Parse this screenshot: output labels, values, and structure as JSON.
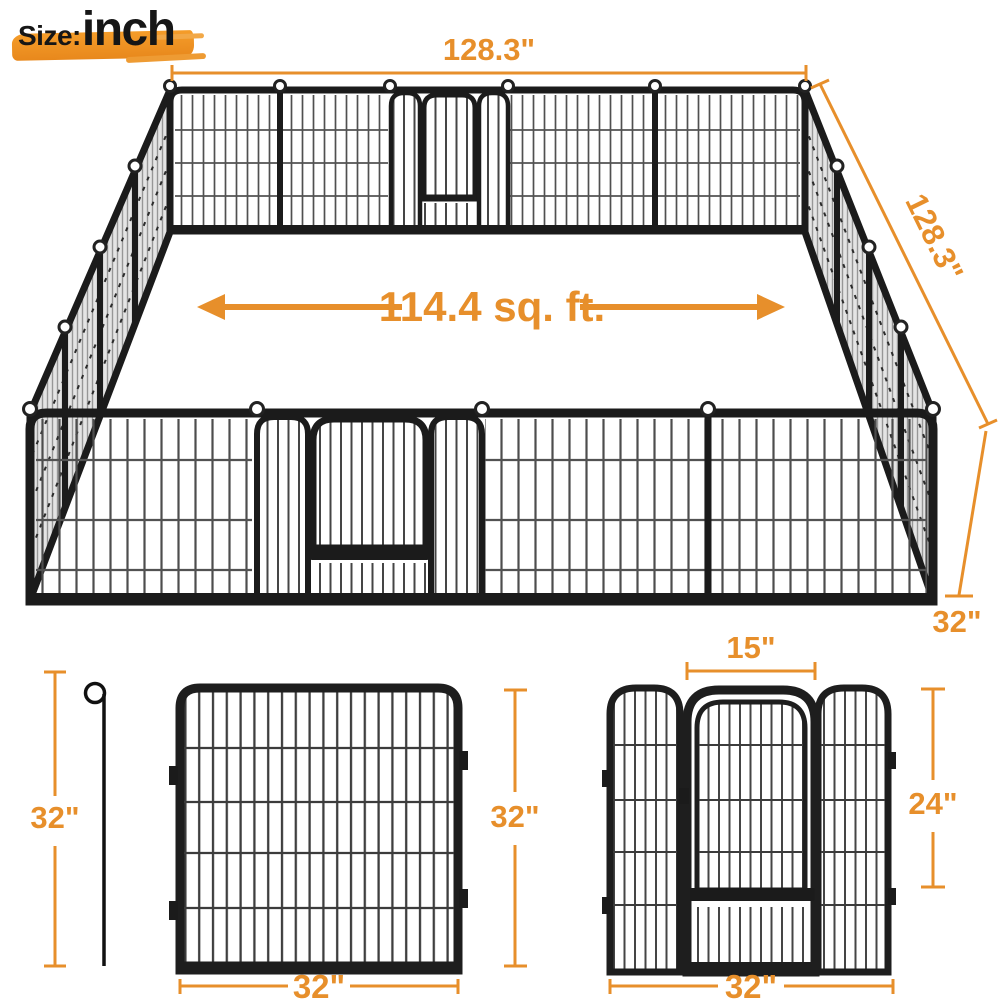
{
  "badge": {
    "prefix": "Size:",
    "unit": "inch"
  },
  "colors": {
    "accent": "#E78F2B",
    "brush": "#F09425",
    "ink": "#161616",
    "frame": "#1b1b1b",
    "mesh_gray": "#e3e3e3"
  },
  "pen_3d": {
    "top_width": "128.3\"",
    "side_depth": "128.3\"",
    "area": "114.4 sq. ft.",
    "corner_height": "32\""
  },
  "stake": {
    "height": "32\""
  },
  "single_panel": {
    "width": "32\"",
    "height": "32\""
  },
  "door_panel": {
    "door_width": "15\"",
    "door_height": "24\"",
    "width": "32\""
  }
}
